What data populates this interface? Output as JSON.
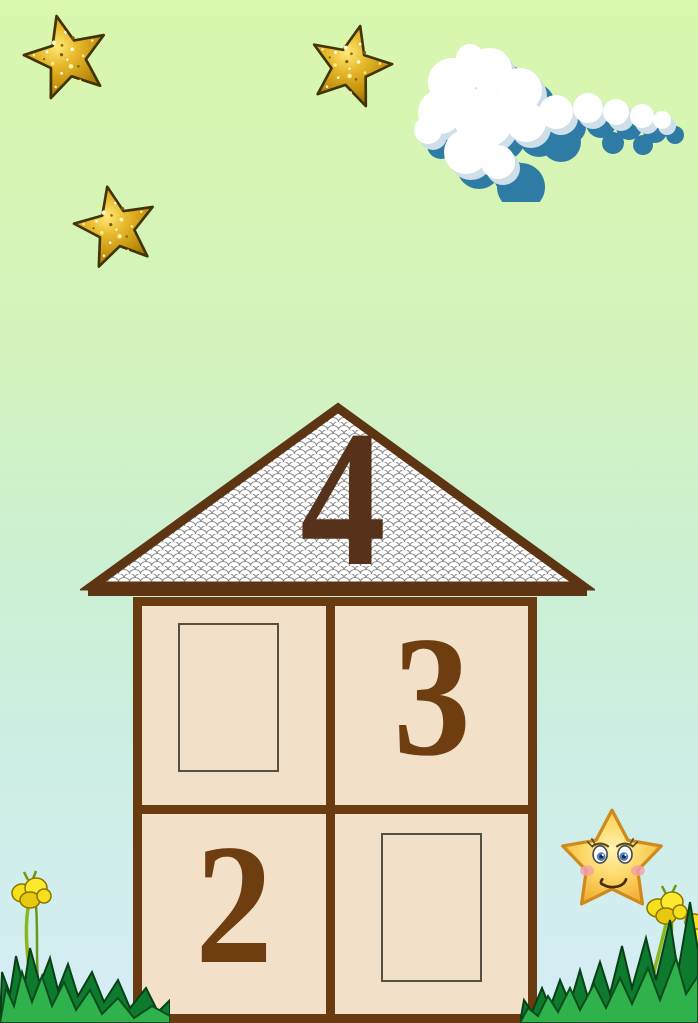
{
  "slide": {
    "roof_number": "4",
    "rooms": [
      {
        "position": "top-left",
        "value": "",
        "has_answer_box": true
      },
      {
        "position": "top-right",
        "value": "3",
        "has_answer_box": false
      },
      {
        "position": "bottom-left",
        "value": "2",
        "has_answer_box": false
      },
      {
        "position": "bottom-right",
        "value": "",
        "has_answer_box": true
      }
    ],
    "colors": {
      "background_top": "#d9f7ad",
      "background_bottom": "#d6edf6",
      "house_wall_brown": "#6a3a10",
      "room_fill_beige": "#f2e0c8",
      "room_number_brown": "#6e3d10",
      "roof_number_brown": "#57321a",
      "cloud_shadow_blue": "#2e7ba6",
      "glitter_star_gold": "#c4920e",
      "grass_green": "#2fb24c",
      "flower_yellow": "#f6e01a",
      "star_character_yellow": "#f7c94a"
    },
    "decorations": [
      {
        "icon": "glitter-star-icon",
        "count": 3
      },
      {
        "icon": "cloud-icon",
        "count": 1
      },
      {
        "icon": "smiling-star-character-icon",
        "count": 1
      },
      {
        "icon": "buttercup-flower-icon",
        "count": 3
      },
      {
        "icon": "grass-tuft-icon",
        "count": 2
      }
    ]
  }
}
